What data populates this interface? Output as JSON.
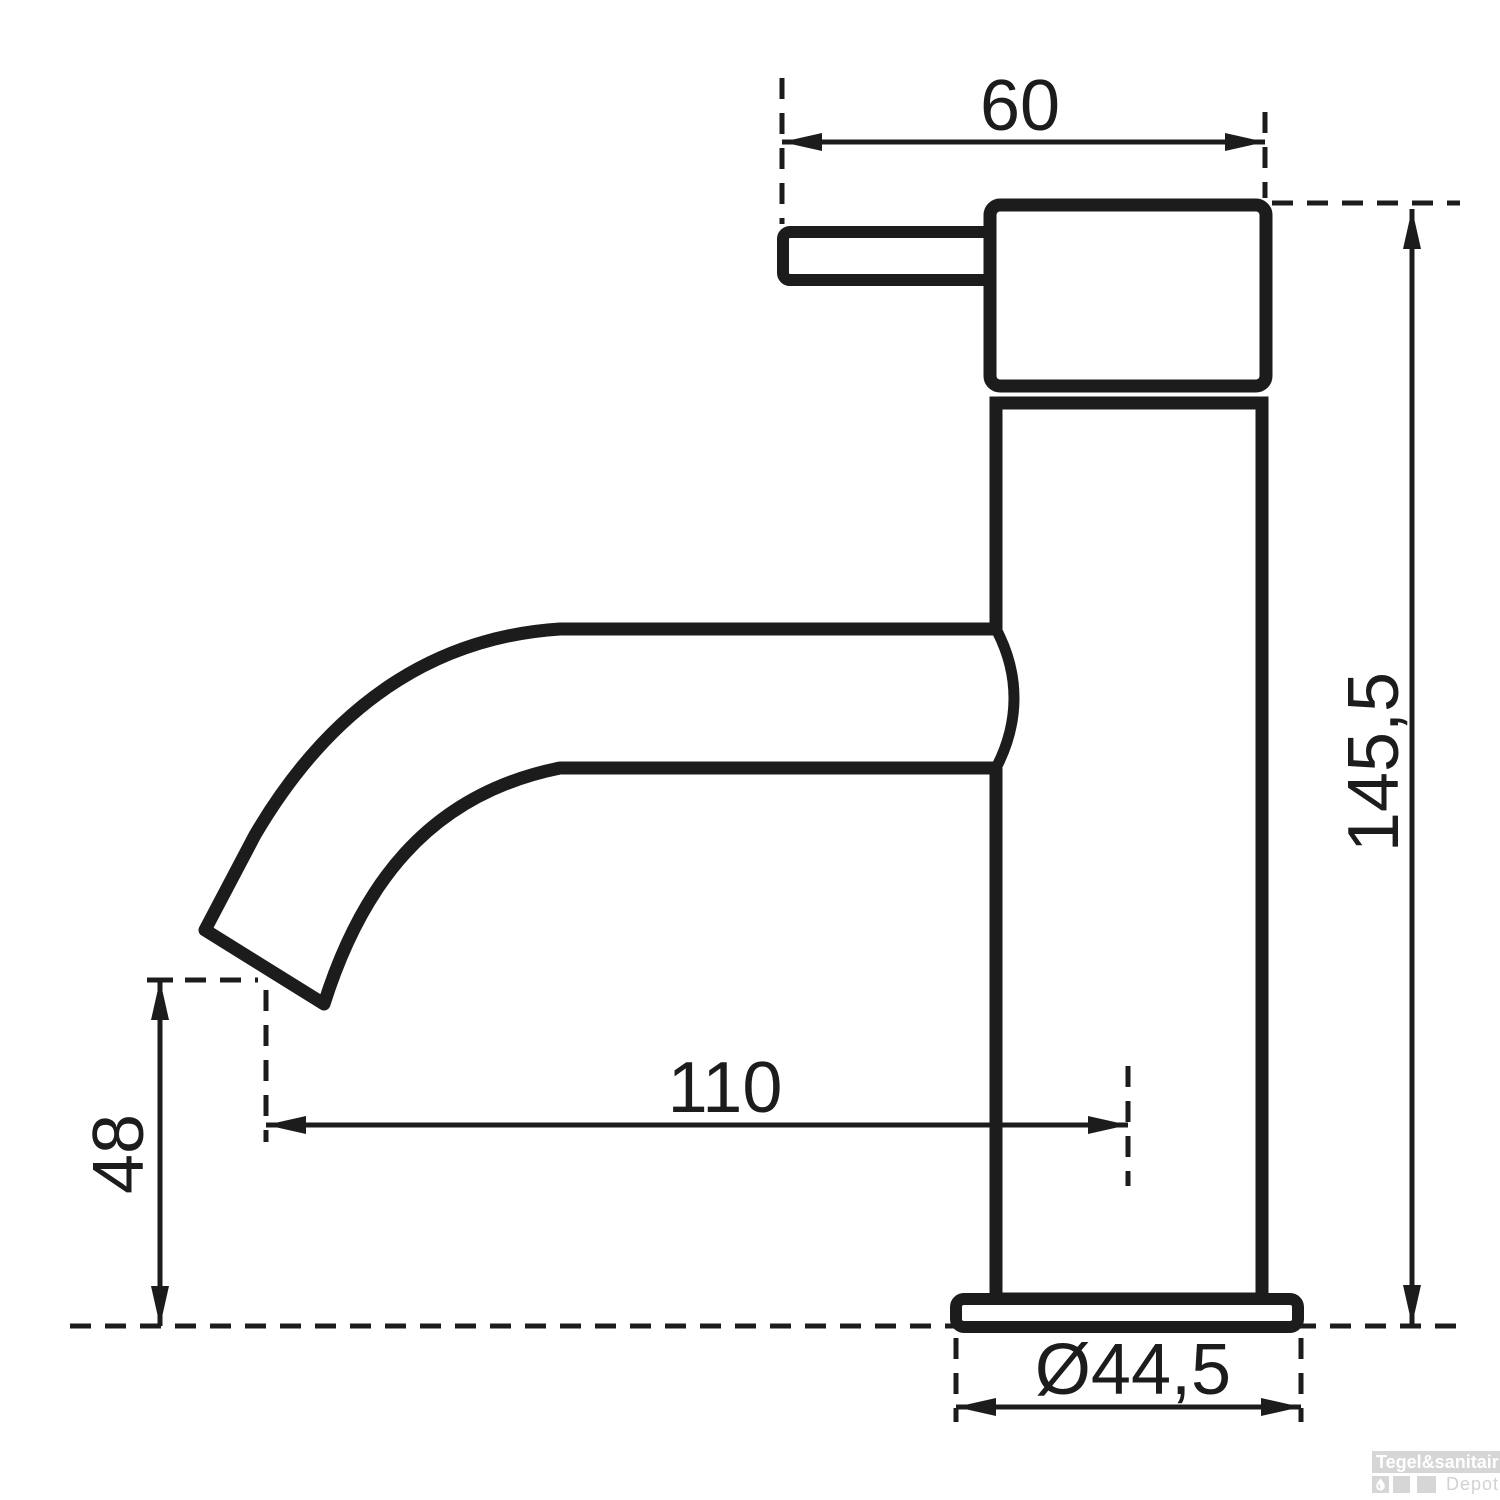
{
  "drawing": {
    "type": "technical-dimension-drawing",
    "subject": "single-lever basin faucet side view",
    "dimension_labels": {
      "handle_length": "60",
      "total_height": "145,5",
      "spout_reach": "110",
      "spout_outlet_height": "48",
      "base_diameter": "Ø44,5"
    },
    "colors": {
      "line": "#1c1c1c",
      "background": "#ffffff",
      "watermark_gray": "#d6d6d6",
      "watermark_text": "#ffffff",
      "watermark_sub_text": "#d2d2d2"
    }
  },
  "watermark": {
    "brand": "Tegel&sanitair",
    "sub_brand": "Depot",
    "logo_icon": "water-droplet-icon"
  }
}
